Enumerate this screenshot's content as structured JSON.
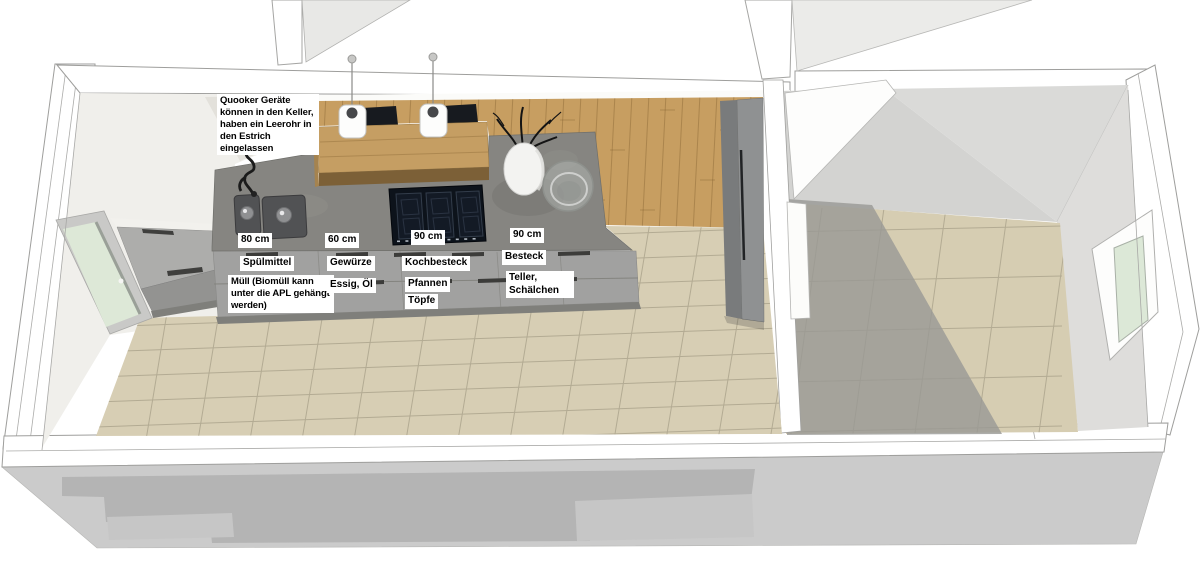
{
  "scene": {
    "type": "kitchen-floorplan-3d",
    "note": "Quooker Geräte können in den Keller, haben ein Leerohr in den Estrich eingelassen",
    "zones": [
      {
        "width_label": "80 cm",
        "drawers": [
          "Spülmittel",
          "Müll (Biomüll kann unter die APL gehängt werden)"
        ]
      },
      {
        "width_label": "60 cm",
        "drawers": [
          "Gewürze",
          "Essig, Öl"
        ]
      },
      {
        "width_label": "90 cm",
        "drawers": [
          "Kochbesteck",
          "Pfannen",
          "Töpfe"
        ]
      },
      {
        "width_label": "90 cm",
        "drawers": [
          "Besteck",
          "Teller, Schälchen"
        ]
      }
    ],
    "objects": [
      "double-sink",
      "faucet",
      "induction-cooktop",
      "bar-counter",
      "pendant-lights",
      "vase-with-branches",
      "glass-bowl",
      "tall-cabinet",
      "corner-cabinet",
      "left-window",
      "right-window",
      "partition-wall"
    ],
    "palette": {
      "wall_white": "#ffffff",
      "wall_light": "#f0efeb",
      "wall_gray": "#d8d8d6",
      "tile_beige": "#d6cdb2",
      "tile_grout": "#b3ab93",
      "wood_floor": "#c79e61",
      "bar_wood": "#c59e63",
      "countertop_concrete": "#868581",
      "cabinet_gray": "#a1a1a0",
      "cooktop_black": "#0d131b",
      "shadow_gray": "#b4b4b4",
      "glass_green": "#dde8d7"
    }
  }
}
